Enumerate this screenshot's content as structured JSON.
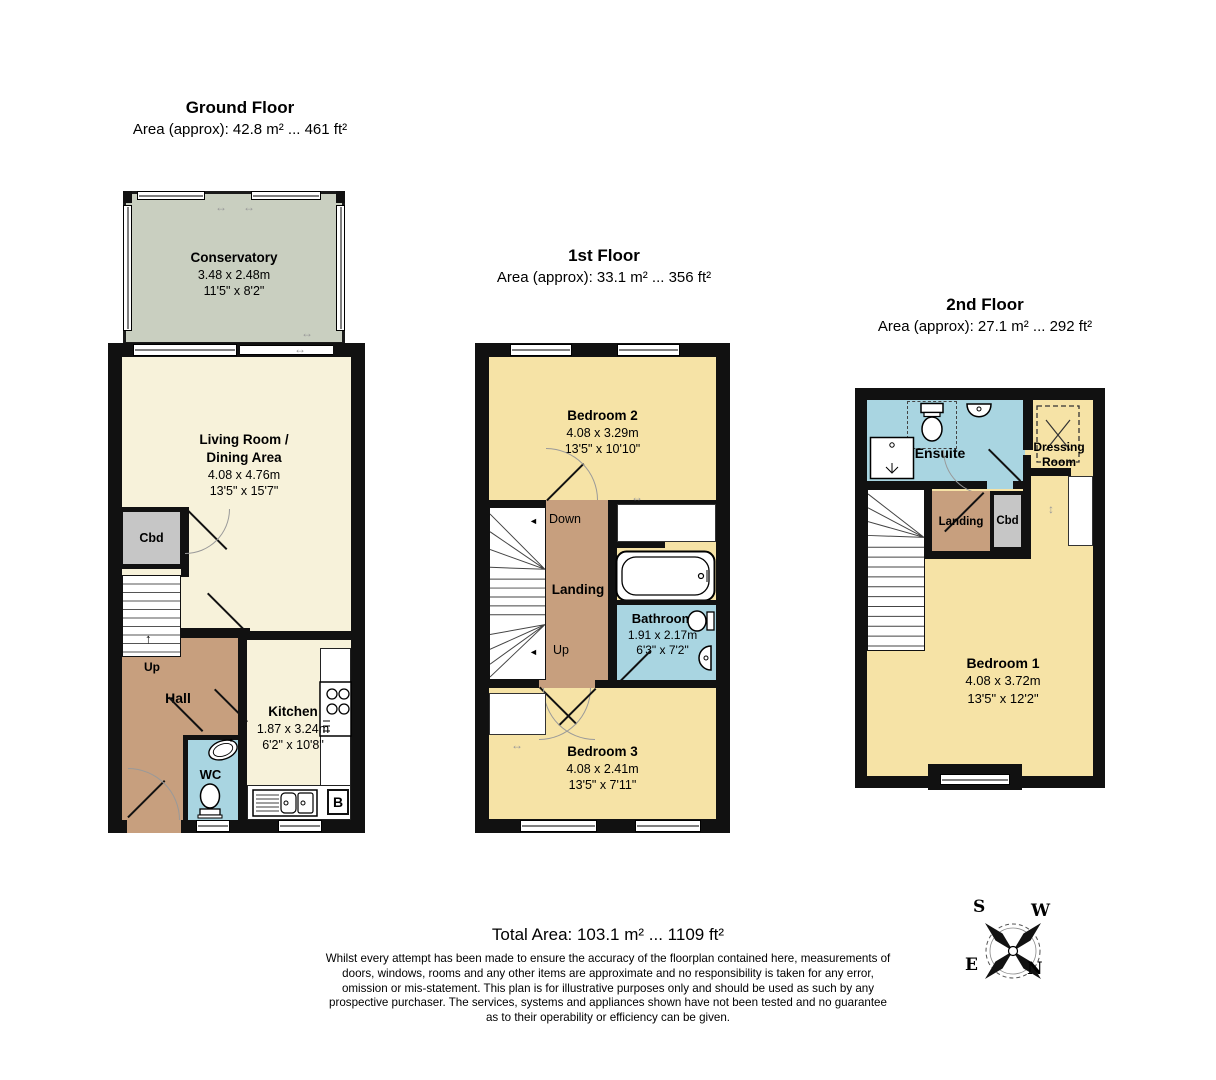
{
  "floors": {
    "ground": {
      "title": "Ground Floor",
      "area": "Area (approx): 42.8 m² ... 461 ft²",
      "conservatory": {
        "name": "Conservatory",
        "metric": "3.48 x 2.48m",
        "imperial": "11'5\" x 8'2\""
      },
      "living": {
        "name_line1": "Living Room /",
        "name_line2": "Dining Area",
        "metric": "4.08 x 4.76m",
        "imperial": "13'5\" x 15'7\""
      },
      "kitchen": {
        "name": "Kitchen",
        "metric": "1.87 x 3.24m",
        "imperial": "6'2\" x 10'8\""
      },
      "hall": "Hall",
      "wc": "WC",
      "cbd": "Cbd",
      "up": "Up",
      "boiler": "B"
    },
    "first": {
      "title": "1st Floor",
      "area": "Area (approx): 33.1 m² ... 356 ft²",
      "bedroom2": {
        "name": "Bedroom 2",
        "metric": "4.08 x 3.29m",
        "imperial": "13'5\" x 10'10\""
      },
      "bedroom3": {
        "name": "Bedroom 3",
        "metric": "4.08 x 2.41m",
        "imperial": "13'5\" x 7'11\""
      },
      "bathroom": {
        "name": "Bathroom",
        "metric": "1.91 x 2.17m",
        "imperial": "6'3\" x 7'2\""
      },
      "landing": "Landing",
      "down": "Down",
      "up": "Up"
    },
    "second": {
      "title": "2nd Floor",
      "area": "Area (approx): 27.1 m² ... 292 ft²",
      "bedroom1": {
        "name": "Bedroom 1",
        "metric": "4.08 x 3.72m",
        "imperial": "13'5\" x 12'2\""
      },
      "ensuite": "Ensuite",
      "dressing": {
        "line1": "Dressing",
        "line2": "Room"
      },
      "landing": "Landing",
      "cbd": "Cbd"
    }
  },
  "footer": {
    "total_area": "Total Area: 103.1 m² ... 1109 ft²",
    "disclaimer": "Whilst every attempt has been made to ensure the accuracy of the floorplan contained here, measurements of doors, windows, rooms and any other items are approximate and no responsibility is taken for any error, omission or mis-statement. This plan is for illustrative purposes only and should be used as such by any prospective purchaser. The services, systems and appliances shown have not been tested and no guarantee as to their operability or efficiency can be given."
  },
  "compass": {
    "north": "N",
    "south": "S",
    "east": "E",
    "west": "W"
  },
  "icons": {
    "up_arrow": "↑",
    "left_arrow": "◄",
    "h_resize": "↔",
    "v_resize": "↕"
  },
  "colors": {
    "wall": "#111111",
    "cream": "#f7f2da",
    "bedroom_yellow": "#f6e3a6",
    "hall_tan": "#c79f7e",
    "wet_blue": "#a9d5e1",
    "conservatory_green": "#c9cfc0",
    "cupboard_gray": "#c6c6c6"
  }
}
